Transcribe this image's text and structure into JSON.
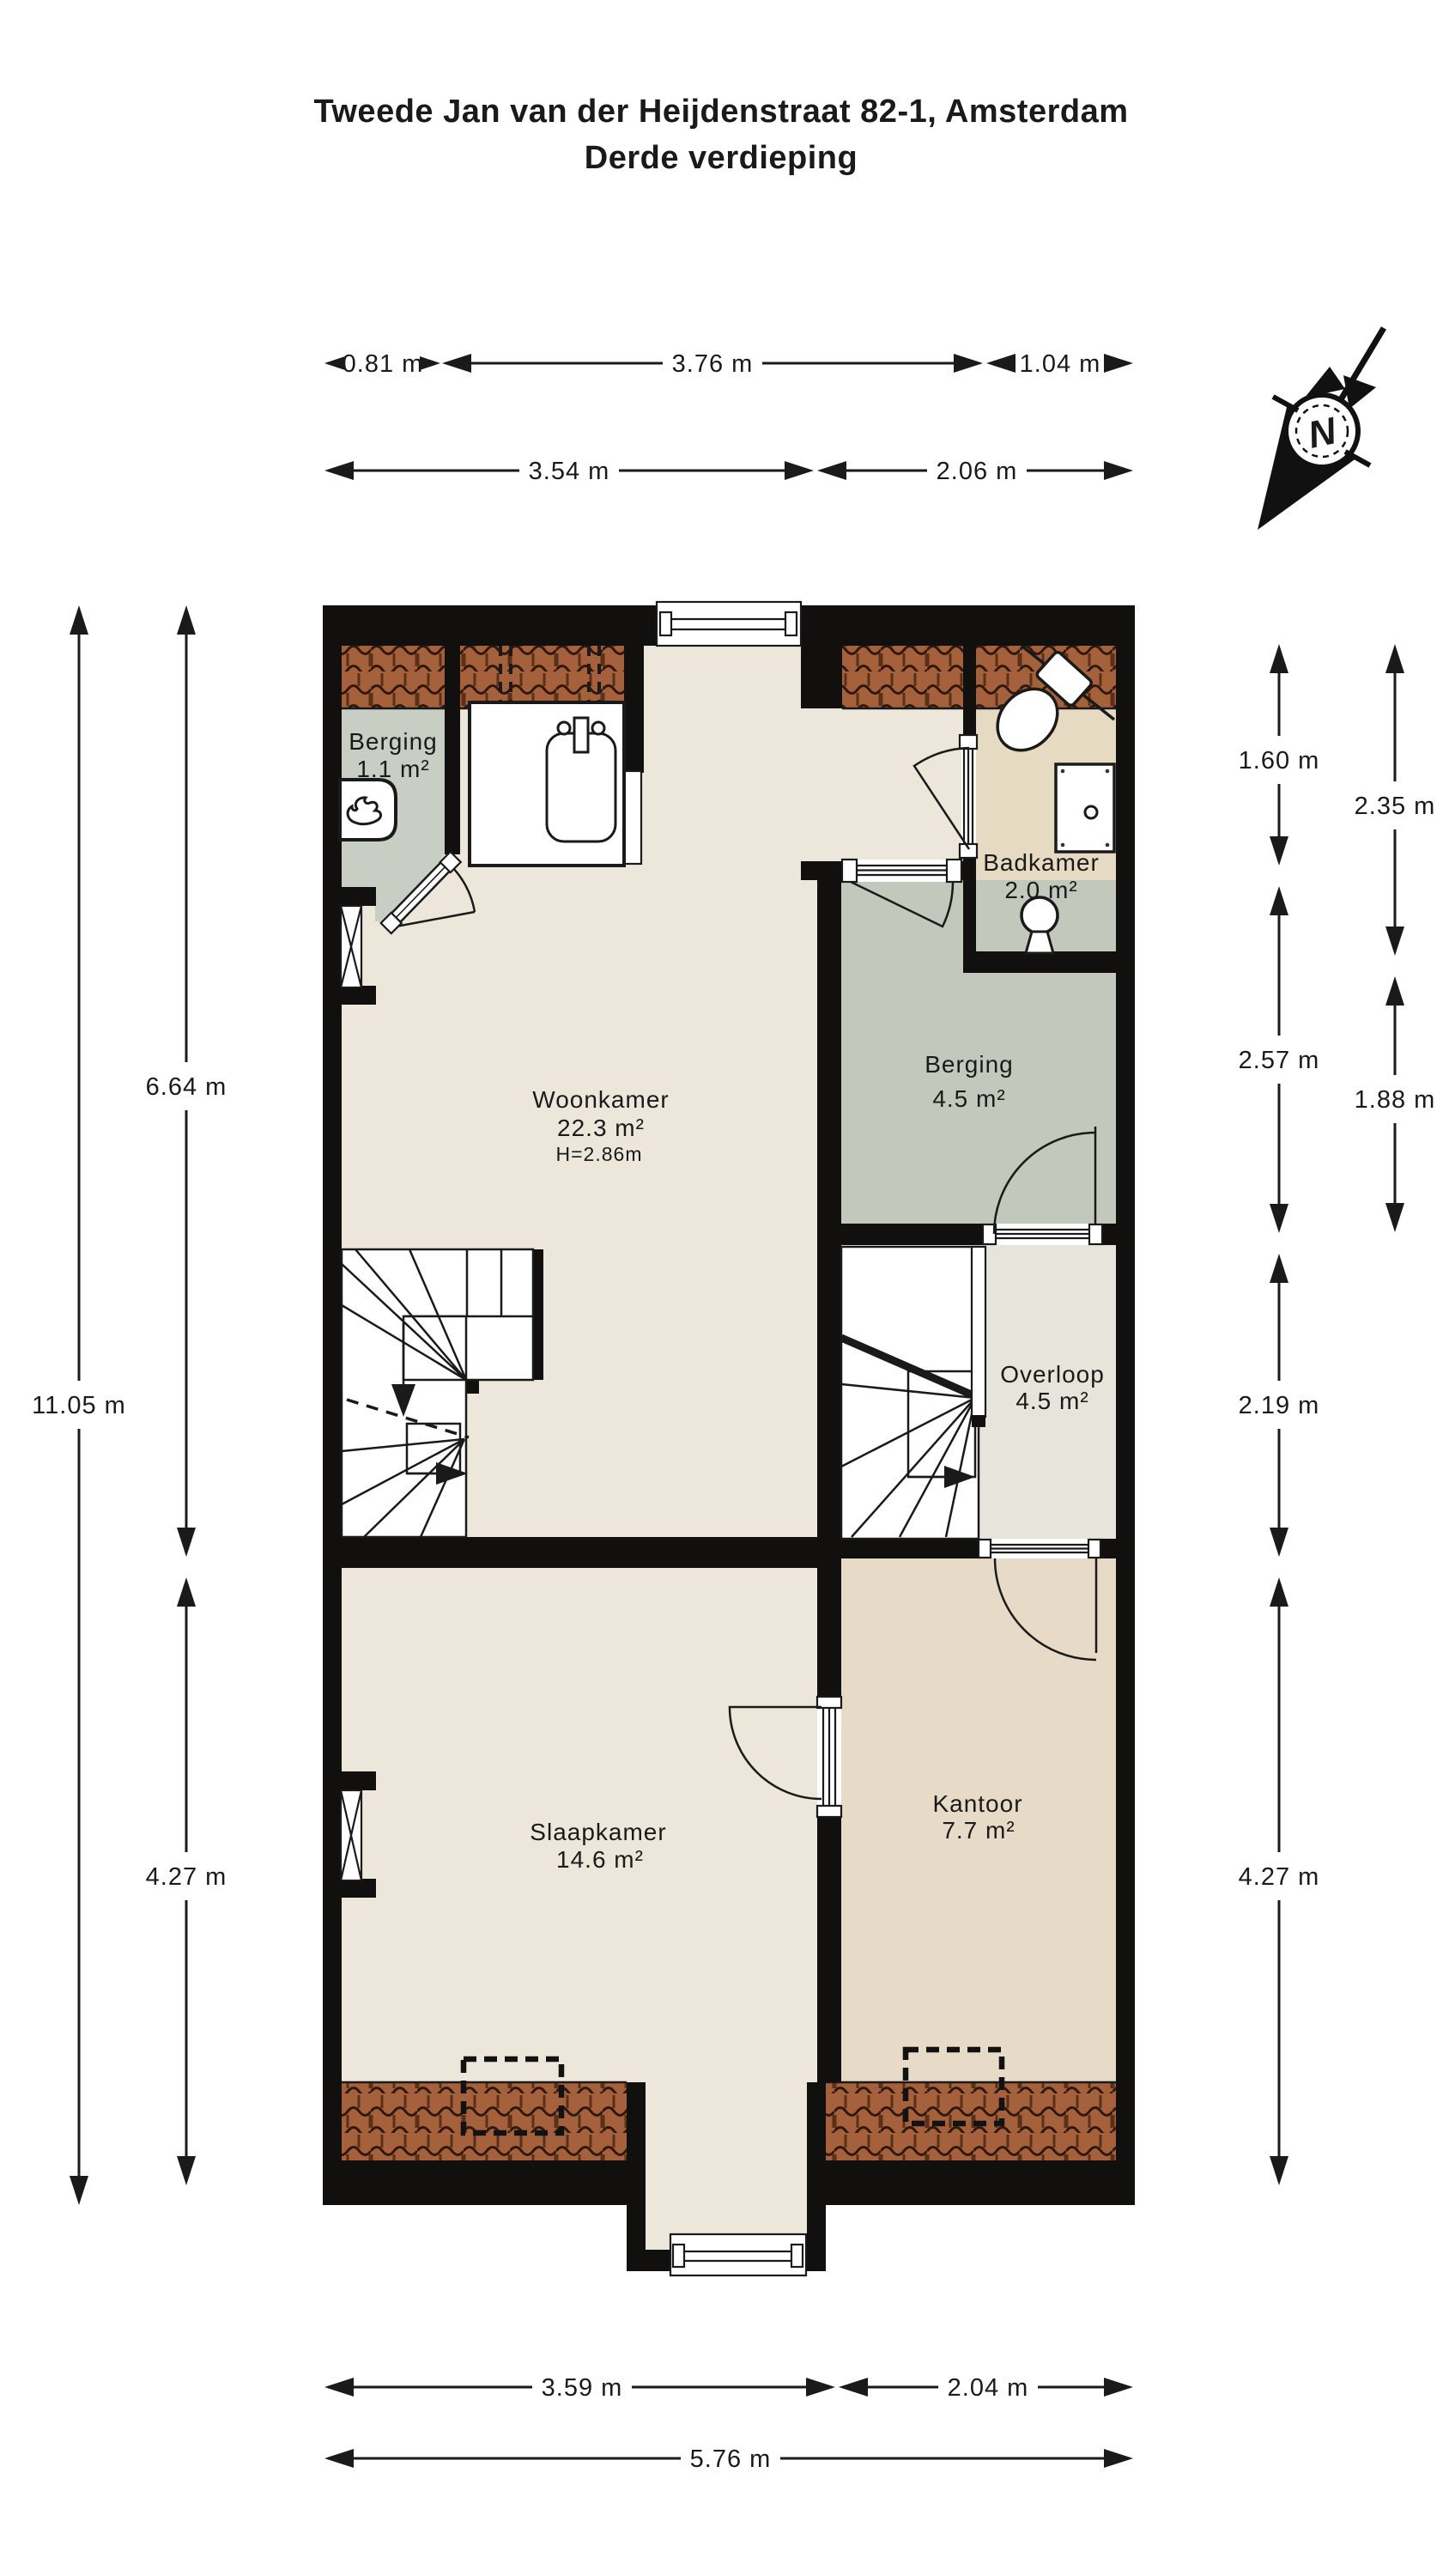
{
  "title": {
    "line1": "Tweede Jan van der Heijdenstraat 82-1, Amsterdam",
    "line2": "Derde verdieping"
  },
  "compass": {
    "label": "N"
  },
  "colors": {
    "wall": "#12100e",
    "line": "#1a1a1a",
    "roof_base": "#a5603c",
    "roof_joint": "#31180d",
    "roof_vjoint": "#5a3018"
  },
  "rooms": {
    "berging_klein": {
      "name": "Berging",
      "area": "1.1 m²",
      "color": "#c9cec4"
    },
    "woonkamer": {
      "name": "Woonkamer",
      "area": "22.3 m²",
      "height": "H=2.86m",
      "color": "#ece7da"
    },
    "badkamer": {
      "name": "Badkamer",
      "area": "2.0 m²",
      "color": "#e6dac2"
    },
    "berging": {
      "name": "Berging",
      "area": "4.5 m²",
      "color": "#c2c8bc"
    },
    "overloop": {
      "name": "Overloop",
      "area": "4.5 m²",
      "color": "#e7e4dc"
    },
    "slaapkamer": {
      "name": "Slaapkamer",
      "area": "14.6 m²",
      "color": "#ece7da"
    },
    "kantoor": {
      "name": "Kantoor",
      "area": "7.7 m²",
      "color": "#e7dbc8"
    }
  },
  "dimensions": {
    "top_row1": [
      "0.81 m",
      "3.76 m",
      "1.04 m"
    ],
    "top_row2": [
      "3.54 m",
      "2.06 m"
    ],
    "left_outer": [
      "11.05 m"
    ],
    "left_inner": [
      "6.64 m",
      "4.27 m"
    ],
    "right_line1": [
      "1.60 m",
      "2.57 m",
      "2.19 m",
      "4.27 m"
    ],
    "right_line2": [
      "2.35 m",
      "1.88 m"
    ],
    "bottom_row1": [
      "3.59 m",
      "2.04 m"
    ],
    "bottom_row2": [
      "5.76 m"
    ]
  }
}
